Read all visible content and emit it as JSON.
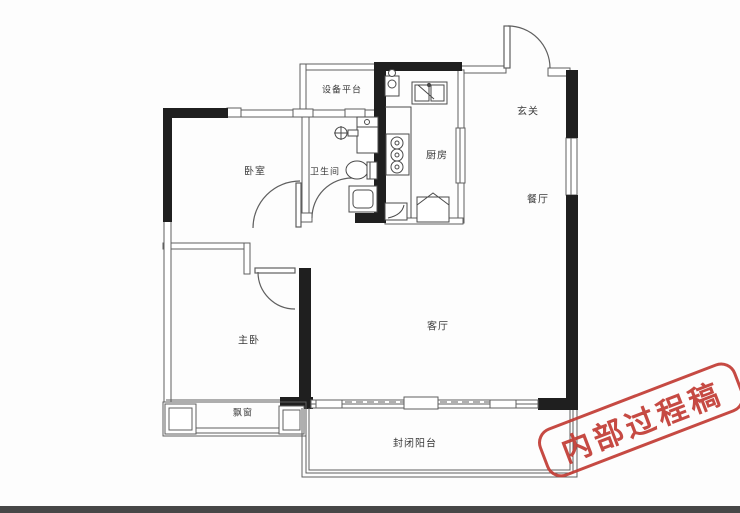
{
  "floorplan": {
    "rooms": {
      "equipment_platform": "设备平台",
      "bedroom": "卧室",
      "bathroom": "卫生间",
      "kitchen": "厨房",
      "entry": "玄关",
      "dining": "餐厅",
      "master_bedroom": "主卧",
      "living_room": "客厅",
      "bay_window": "飘窗",
      "balcony": "封闭阳台"
    },
    "stamp": {
      "text": "内部过程稿",
      "color": "#c23b34"
    },
    "colors": {
      "wall": "#1f1f1f",
      "line": "#5f5f5f",
      "fixture": "#4a4a4a"
    }
  }
}
